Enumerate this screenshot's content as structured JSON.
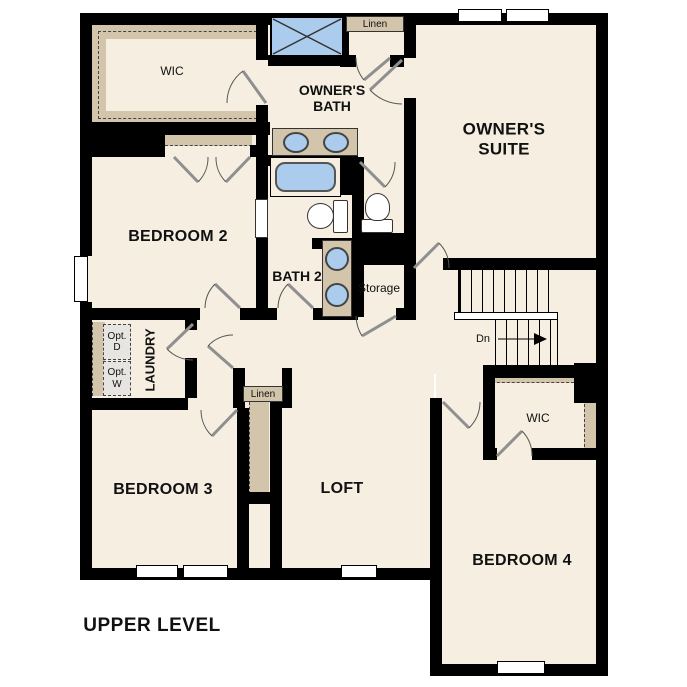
{
  "title": "UPPER LEVEL",
  "colors": {
    "background": "#ffffff",
    "floor": "#f5eee1",
    "wall": "#000000",
    "millwork_tan": "#d2c5ab",
    "fixture_blue": "#abccec",
    "optional_gray": "#e6e5e1",
    "door_swing_gray": "#8f8f8f",
    "text": "#111111"
  },
  "labels": {
    "owners_wic": "WIC",
    "linen_upper": "Linen",
    "owners_bath": [
      "OWNER'S",
      "BATH"
    ],
    "owners_suite": [
      "OWNER'S",
      "SUITE"
    ],
    "bedroom2": "BEDROOM 2",
    "bath2": "BATH 2",
    "storage": "Storage",
    "stairs_down": "Dn",
    "opt_dryer": [
      "Opt.",
      "D"
    ],
    "opt_washer": [
      "Opt.",
      "W"
    ],
    "laundry": "LAUNDRY",
    "linen_lower": "Linen",
    "bedroom3": "BEDROOM 3",
    "loft": "LOFT",
    "bedroom4_wic": "WIC",
    "bedroom4": "BEDROOM 4",
    "level": "UPPER LEVEL"
  },
  "fixtures": [
    "shower",
    "double-vanity-sinks",
    "bathtub",
    "toilet-owners-wc",
    "toilet-bath2",
    "double-vanity-sinks-bath2",
    "optional-dryer",
    "optional-washer",
    "stairs-down",
    "pocket-door"
  ]
}
